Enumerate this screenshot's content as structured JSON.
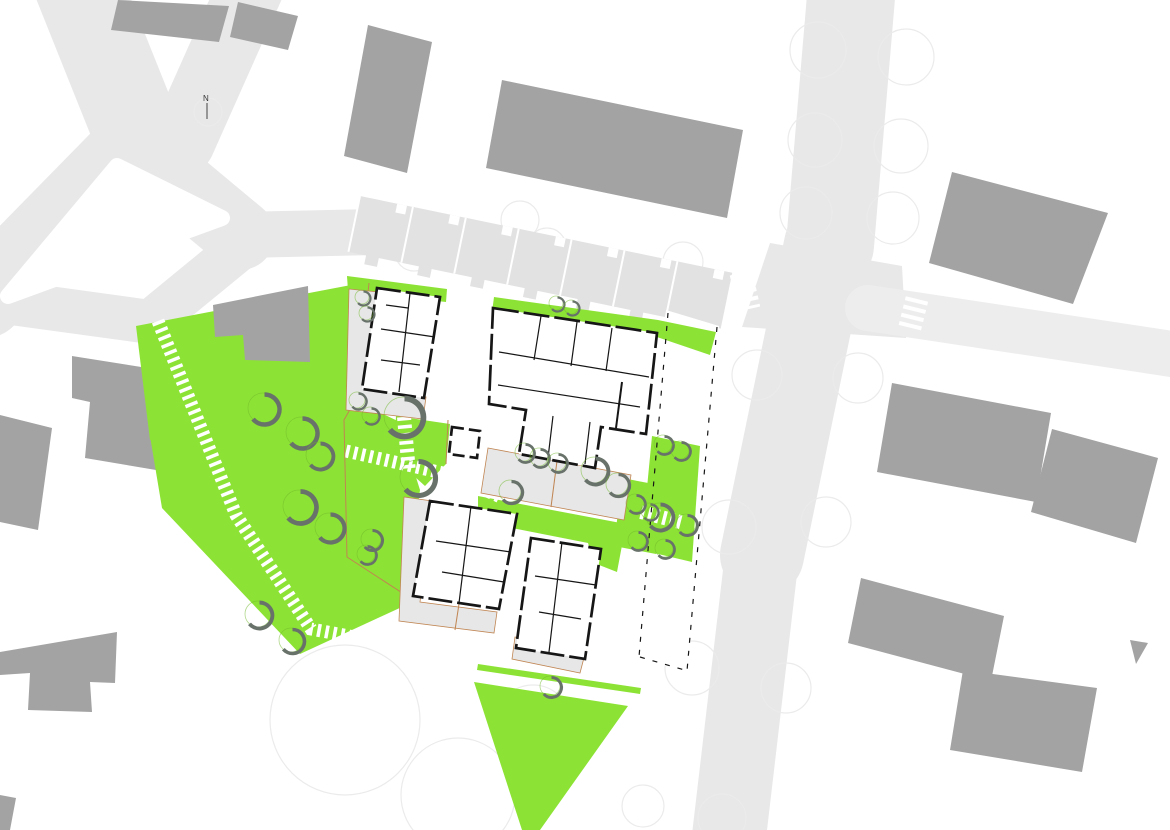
{
  "meta": {
    "type": "architectural-site-plan"
  },
  "north": {
    "label": "N"
  },
  "colors": {
    "background": "#ffffff",
    "road": "#e8e8e8",
    "road_light": "#ededed",
    "row_house": "#e2e2e2",
    "context_building": "#a3a3a3",
    "green": "#8de335",
    "tree_ring": "#6fb82a",
    "tree_shadow": "#68726a",
    "patio": "#e7e7e7",
    "boundary": "#c08552",
    "wall": "#161616",
    "faint": "#ebebeb"
  },
  "site": {
    "trees": [
      [
        263,
        408,
        15
      ],
      [
        301,
        432,
        15
      ],
      [
        319,
        455,
        13
      ],
      [
        299,
        506,
        16
      ],
      [
        329,
        527,
        14
      ],
      [
        371,
        539,
        10
      ],
      [
        366,
        554,
        9
      ],
      [
        258,
        614,
        13
      ],
      [
        291,
        640,
        12
      ],
      [
        417,
        477,
        17
      ],
      [
        403,
        416,
        19
      ],
      [
        357,
        400,
        8
      ],
      [
        370,
        415,
        8
      ],
      [
        362,
        297,
        7
      ],
      [
        366,
        313,
        7
      ],
      [
        524,
        452,
        9
      ],
      [
        539,
        457,
        9
      ],
      [
        557,
        462,
        9
      ],
      [
        594,
        470,
        13
      ],
      [
        617,
        484,
        11
      ],
      [
        635,
        503,
        9
      ],
      [
        649,
        511,
        8
      ],
      [
        510,
        491,
        11
      ],
      [
        550,
        686,
        10
      ],
      [
        556,
        303,
        7
      ],
      [
        571,
        307,
        7
      ],
      [
        663,
        444,
        9
      ],
      [
        680,
        450,
        9
      ],
      [
        659,
        516,
        13
      ],
      [
        686,
        524,
        10
      ],
      [
        637,
        540,
        9
      ],
      [
        664,
        548,
        9
      ]
    ],
    "faint_circles": [
      [
        818,
        50,
        28
      ],
      [
        906,
        57,
        28
      ],
      [
        815,
        140,
        27
      ],
      [
        901,
        146,
        27
      ],
      [
        806,
        213,
        26
      ],
      [
        893,
        218,
        26
      ],
      [
        757,
        375,
        25
      ],
      [
        858,
        378,
        25
      ],
      [
        729,
        527,
        27
      ],
      [
        826,
        522,
        25
      ],
      [
        786,
        688,
        25
      ],
      [
        722,
        818,
        24
      ],
      [
        345,
        720,
        75
      ],
      [
        458,
        795,
        57
      ],
      [
        533,
        723,
        38
      ],
      [
        692,
        668,
        27
      ],
      [
        643,
        806,
        21
      ],
      [
        414,
        252,
        19
      ],
      [
        520,
        220,
        19
      ],
      [
        547,
        247,
        19
      ],
      [
        683,
        262,
        20
      ],
      [
        208,
        112,
        14
      ]
    ],
    "white_stripe_paths": [
      {
        "d": "M158,321 L236,515 L311,629 L468,658",
        "w": 13,
        "dash": "3.5 4.5"
      },
      {
        "d": "M346,451 L500,486",
        "w": 13,
        "dash": "3.5 4.5"
      },
      {
        "d": "M446,470 L501,495",
        "w": 17,
        "dash": "3.5 4.5"
      },
      {
        "d": "M404,417 L409,472",
        "w": 14,
        "dash": "3.5 4.5"
      },
      {
        "d": "M641,512 L684,523",
        "w": 14,
        "dash": "3.5 4"
      },
      {
        "d": "M741,273 L749,309",
        "w": 23,
        "dash": "4 4.5"
      },
      {
        "d": "M917,299 L909,331",
        "w": 23,
        "dash": "4 4.5"
      }
    ],
    "terrace_row": {
      "count": 7,
      "start": [
        360,
        196
      ],
      "step": [
        52.9,
        10.9
      ],
      "size": [
        56,
        57
      ],
      "angle": 11.7
    }
  }
}
